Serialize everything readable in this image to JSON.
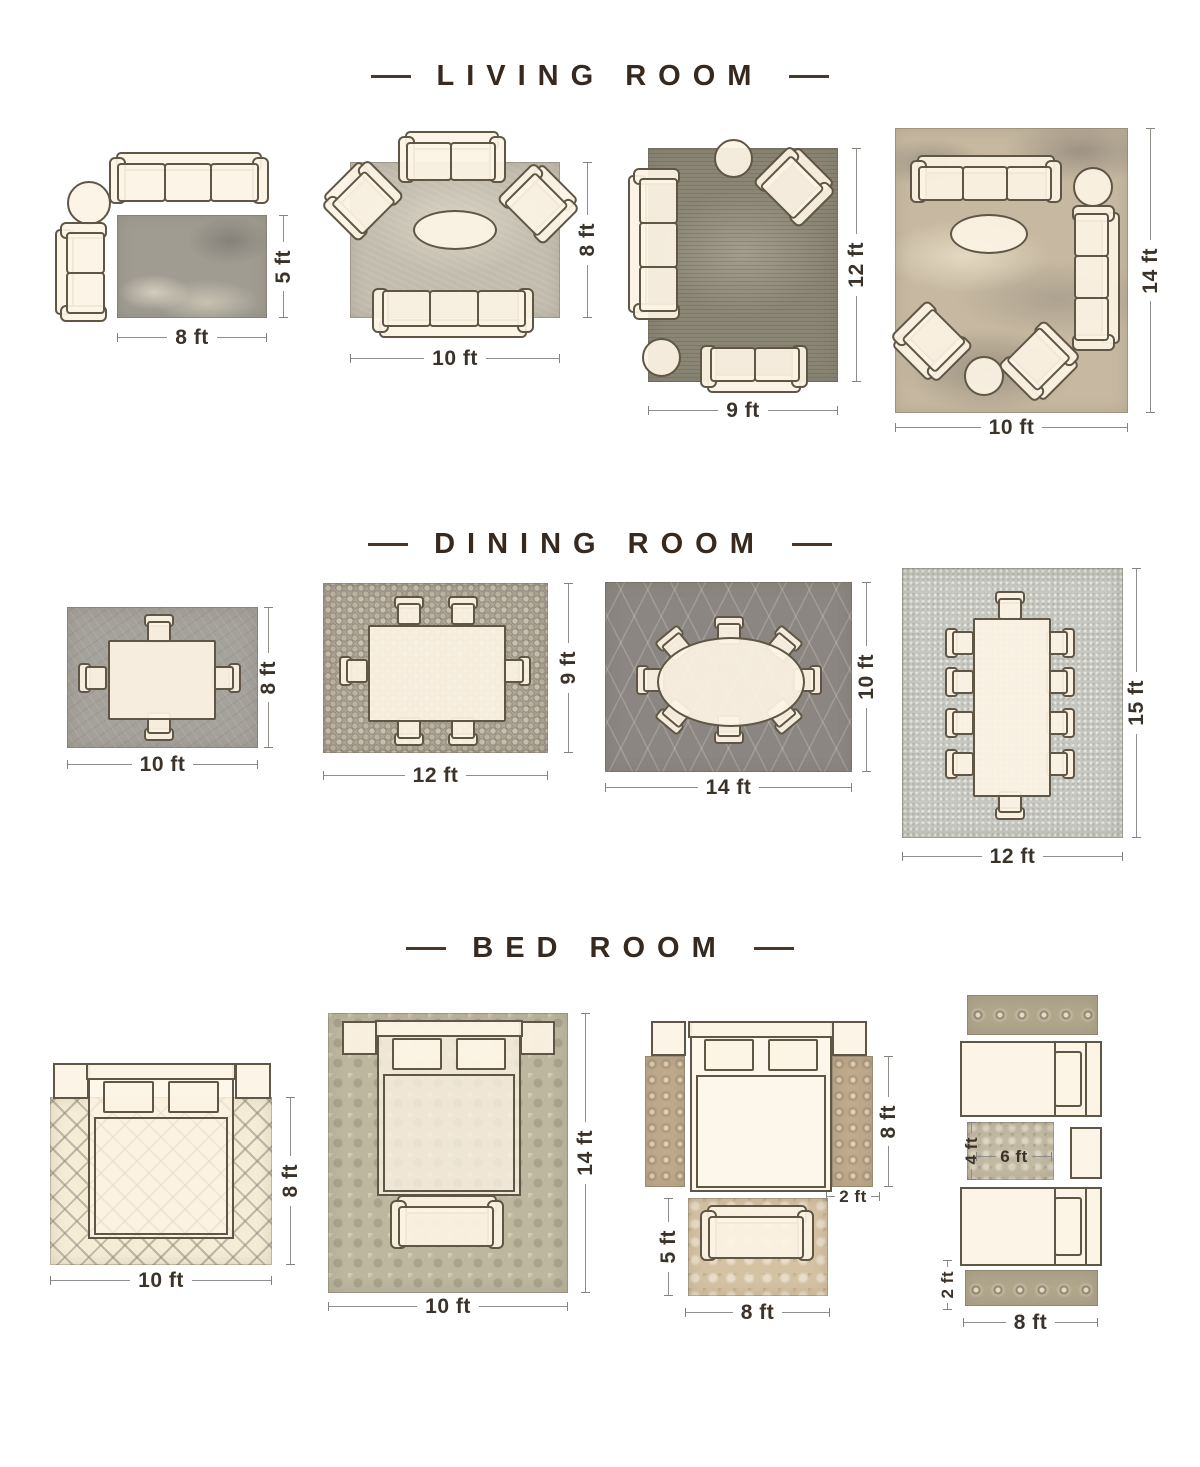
{
  "palette": {
    "accent_brown": "#37291d",
    "dimension_text": "#3b332a",
    "dimension_line": "#908e89",
    "furniture_fill": "#fcf3e4",
    "furniture_outline": "#5f5645"
  },
  "sections": [
    {
      "title": "LIVING ROOM",
      "layouts": [
        {
          "name": "living-rug-8x5",
          "bottom": "8 ft",
          "side": "5 ft"
        },
        {
          "name": "living-rug-10x8",
          "bottom": "10 ft",
          "side": "8 ft"
        },
        {
          "name": "living-rug-9x12",
          "bottom": "9 ft",
          "side": "12 ft"
        },
        {
          "name": "living-rug-10x14",
          "bottom": "10 ft",
          "side": "14 ft"
        }
      ]
    },
    {
      "title": "DINING ROOM",
      "layouts": [
        {
          "name": "dining-rug-10x8",
          "bottom": "10 ft",
          "side": "8 ft"
        },
        {
          "name": "dining-rug-12x9",
          "bottom": "12 ft",
          "side": "9 ft"
        },
        {
          "name": "dining-rug-14x10",
          "bottom": "14 ft",
          "side": "10 ft"
        },
        {
          "name": "dining-rug-12x15",
          "bottom": "12 ft",
          "side": "15 ft"
        }
      ]
    },
    {
      "title": "BED ROOM",
      "layouts": [
        {
          "name": "bed-rug-10x8",
          "bottom": "10 ft",
          "side": "8 ft"
        },
        {
          "name": "bed-rug-10x14",
          "bottom": "10 ft",
          "side": "14 ft"
        },
        {
          "name": "bed-runner-set",
          "bottom": "8 ft",
          "runner_side": "8 ft",
          "runner_width": "2 ft",
          "foot_side": "5 ft"
        },
        {
          "name": "twin-bed-set",
          "bottom": "8 ft",
          "mid_width": "6 ft",
          "mid_side": "4 ft",
          "runner_side": "2 ft"
        }
      ]
    }
  ]
}
